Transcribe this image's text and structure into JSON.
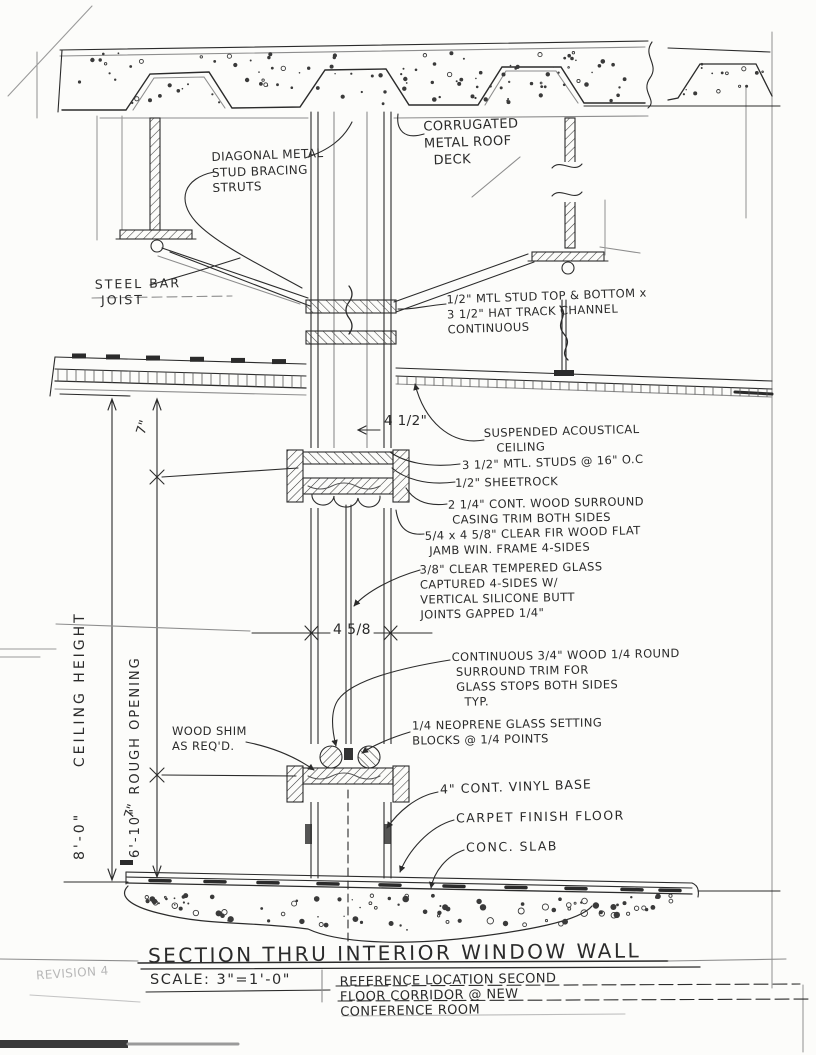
{
  "drawing": {
    "title": "SECTION THRU INTERIOR WINDOW WALL",
    "scale_label": "SCALE: 3\"=1'-0\"",
    "reference_note": "REFERENCE LOCATION SECOND\nFLOOR CORRIDOR @ NEW\nCONFERENCE ROOM",
    "stamp": "REVISION 4"
  },
  "callouts": {
    "corrugated_deck": "CORRUGATED\nMETAL ROOF\n  DECK",
    "diagonal_bracing": "DIAGONAL METAL\nSTUD BRACING\nSTRUTS",
    "steel_bar_joist": "STEEL BAR\n JOIST",
    "hat_track": "1/2\" MTL STUD TOP & BOTTOM x\n3 1/2\" HAT TRACK CHANNEL\nCONTINUOUS",
    "suspended_ceiling": "SUSPENDED ACOUSTICAL\n   CEILING",
    "mtl_studs": "3 1/2\" MTL. STUDS @ 16\" O.C",
    "sheetrock": "1/2\" SHEETROCK",
    "casing_trim": "2 1/4\" CONT. WOOD SURROUND\n CASING TRIM BOTH SIDES",
    "jamb_frame": "5/4 x 4 5/8\" CLEAR FIR WOOD FLAT\n JAMB WIN. FRAME 4-SIDES",
    "tempered_glass": "3/8\" CLEAR TEMPERED GLASS\nCAPTURED 4-SIDES W/\nVERTICAL SILICONE BUTT\nJOINTS GAPPED 1/4\"",
    "quarter_round_trim": "CONTINUOUS 3/4\" WOOD 1/4 ROUND\n SURROUND TRIM FOR\n GLASS STOPS BOTH SIDES\n   TYP.",
    "wood_shim": "WOOD SHIM\nAS REQ'D.",
    "neoprene_blocks": "1/4 NEOPRENE GLASS SETTING\nBLOCKS @ 1/4 POINTS",
    "vinyl_base": "4\" CONT. VINYL BASE",
    "carpet": "CARPET FINISH FLOOR",
    "conc_slab": "CONC. SLAB"
  },
  "dimensions": {
    "wall_width": "4 1/2\"",
    "jamb_depth": "4 5/8",
    "head_height": "7\"",
    "sill_height": "7\"",
    "ceiling_height": "8'-0\"      CEILING HEIGHT",
    "rough_opening": "6'-10\"  ROUGH OPENING"
  },
  "colors": {
    "ink": "#2b2b2b",
    "paper": "#fcfcfa",
    "faint": "#8d8d8d"
  }
}
